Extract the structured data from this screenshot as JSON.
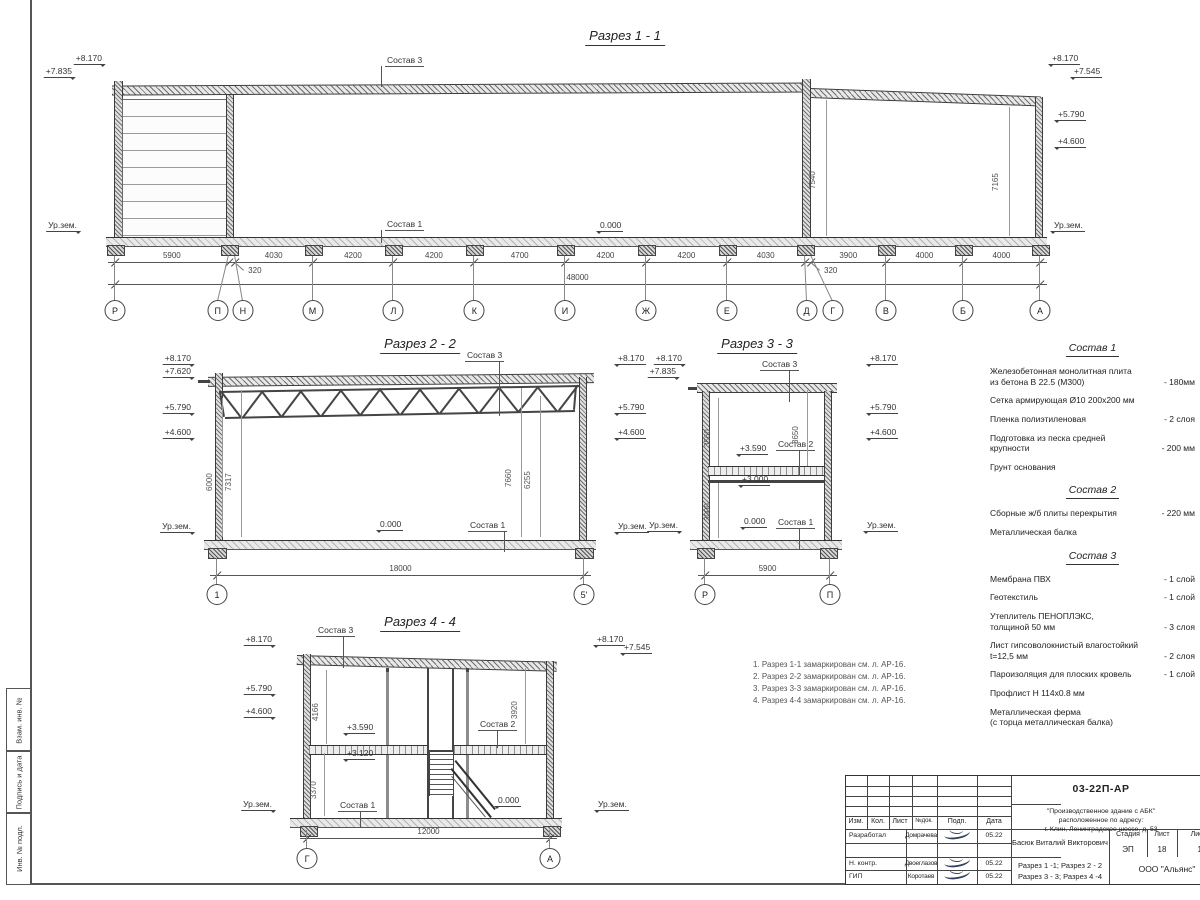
{
  "drawing": {
    "sections": {
      "s1": {
        "title": "Разрез 1 - 1",
        "axes": [
          "Р",
          "П",
          "Н",
          "М",
          "Л",
          "К",
          "И",
          "Ж",
          "Е",
          "Д",
          "Г",
          "В",
          "Б",
          "А"
        ],
        "dims": [
          "5900",
          "320",
          "4030",
          "4200",
          "4200",
          "4700",
          "4200",
          "4200",
          "4030",
          "320",
          "3900",
          "4000",
          "4000"
        ],
        "total": "48000",
        "levels_left": [
          "+8.170",
          "+7.835"
        ],
        "levels_right": [
          "+8.170",
          "+7.545",
          "+5.790",
          "+4.600"
        ],
        "ground_label": "Ур.зем.",
        "zero_label": "0.000",
        "roof_label": "Состав 3",
        "floor_label": "Состав 1",
        "vdims": [
          "7540",
          "7165"
        ]
      },
      "s2": {
        "title": "Разрез 2 - 2",
        "axes": [
          "1",
          "5'"
        ],
        "total": "18000",
        "levels_left": [
          "+8.170",
          "+7.620",
          "+5.790",
          "+4.600"
        ],
        "levels_right": [
          "+8.170",
          "+5.790",
          "+4.600"
        ],
        "ground_label": "Ур.зем.",
        "zero_label": "0.000",
        "roof_label": "Состав 3",
        "floor_label": "Состав 1",
        "vdims": [
          "6000",
          "7317",
          "7660",
          "6255"
        ]
      },
      "s3": {
        "title": "Разрез 3 - 3",
        "axes": [
          "Р",
          "П"
        ],
        "total": "5900",
        "levels_left": [
          "+8.170",
          "+7.835"
        ],
        "levels_right": [
          "+8.170",
          "+5.790",
          "+4.600"
        ],
        "ground_label": "Ур.зем.",
        "zero_label": "0.000",
        "marks": [
          "+3.590",
          "+3.000"
        ],
        "labels": [
          "Состав 3",
          "Состав 2",
          "Состав 1"
        ],
        "vdims": [
          "3560",
          "3650",
          "3000"
        ]
      },
      "s4": {
        "title": "Разрез 4 - 4",
        "axes": [
          "Г",
          "А"
        ],
        "total": "12000",
        "levels_left": [
          "+8.170",
          "+5.790",
          "+4.600"
        ],
        "levels_right": [
          "+8.170",
          "+7.545"
        ],
        "ground_label": "Ур.зем.",
        "zero_label": "0.000",
        "marks": [
          "+3.590",
          "+3.120"
        ],
        "labels": [
          "Состав 3",
          "Состав 2",
          "Состав 1"
        ],
        "vdims": [
          "4166",
          "3370",
          "3920"
        ]
      }
    },
    "notes": [
      "1. Разрез 1-1 замаркирован см. л. АР-16.",
      "2. Разрез 2-2 замаркирован см. л. АР-16.",
      "3. Разрез 3-3 замаркирован см. л. АР-16.",
      "4. Разрез 4-4 замаркирован см. л. АР-16."
    ],
    "compositions": [
      {
        "title": "Состав 1",
        "items": [
          {
            "text": "Железобетонная  монолитная плита\nиз бетона В 22.5 (М300)",
            "value": "- 180мм"
          },
          {
            "text": "Сетка армирующая Ø10 200х200 мм",
            "value": ""
          },
          {
            "text": "Пленка полиэтиленовая",
            "value": "- 2 слоя"
          },
          {
            "text": "Подготовка из песка средней\nкрупности",
            "value": "- 200 мм"
          },
          {
            "text": "Грунт основания",
            "value": ""
          }
        ]
      },
      {
        "title": "Состав 2",
        "items": [
          {
            "text": "Сборные ж/б плиты перекрытия",
            "value": "- 220 мм"
          },
          {
            "text": "Металлическая балка",
            "value": ""
          }
        ]
      },
      {
        "title": "Состав 3",
        "items": [
          {
            "text": "Мембрана ПВХ",
            "value": "- 1 слой"
          },
          {
            "text": "Геотекстиль",
            "value": "- 1 слой"
          },
          {
            "text": "Утеплитель ПЕНОПЛЭКС,\nтолщиной 50 мм",
            "value": "- 3 слоя"
          },
          {
            "text": "Лист гипсоволокнистый влагостойкий\nt=12,5 мм",
            "value": "- 2 слоя"
          },
          {
            "text": "Пароизоляция для плоских кровель",
            "value": "- 1 слой"
          },
          {
            "text": "Профлист Н 114х0.8 мм",
            "value": ""
          },
          {
            "text": "Металлическая ферма\n(с торца металлическая балка)",
            "value": ""
          }
        ]
      }
    ]
  },
  "titleblock": {
    "code": "03-22П-АР",
    "project": "\"Производственное здание с АБК\" расположенное по адресу:\nг. Клин, Ленинградское шоссе, д. 53",
    "columns": [
      "Изм.",
      "Кол.",
      "Лист",
      "№док.",
      "Подп.",
      "Дата"
    ],
    "rows": [
      {
        "role": "Разработал",
        "name": "Домрачева",
        "date": "05.22"
      },
      {
        "role": "Н. контр.",
        "name": "Двоеглазов",
        "date": "05.22"
      },
      {
        "role": "ГИП",
        "name": "Коротаев",
        "date": "05.22"
      }
    ],
    "author": "Басюк Виталий Викторович",
    "sheet_title": "Разрез 1 -1;  Разрез 2 - 2\nРазрез 3 - 3;  Разрез 4 -4",
    "stage_label": "Стадия",
    "sheet_label": "Лист",
    "sheets_label": "Листов",
    "stage": "ЭП",
    "sheet": "18",
    "sheets": "19",
    "company": "ООО \"Альянс\""
  },
  "frame": {
    "side_labels": [
      "Взам. инв. №",
      "Подпись и дата",
      "Инв. № подл."
    ]
  }
}
